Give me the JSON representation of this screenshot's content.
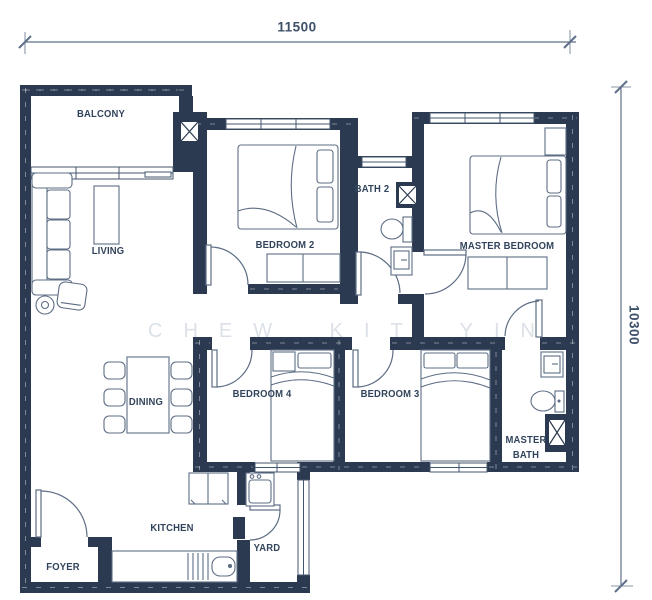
{
  "plan": {
    "type": "apartment-floor-plan",
    "watermark": "CHEW KIT YIN",
    "dimensions": {
      "width_label": "11500",
      "height_label": "10300"
    },
    "rooms": {
      "balcony": {
        "label": "BALCONY"
      },
      "living": {
        "label": "LIVING"
      },
      "dining": {
        "label": "DINING"
      },
      "bedroom2": {
        "label": "BEDROOM 2"
      },
      "bath2": {
        "label": "BATH 2"
      },
      "master_bedroom": {
        "label": "MASTER BEDROOM"
      },
      "bedroom4": {
        "label": "BEDROOM 4"
      },
      "bedroom3": {
        "label": "BEDROOM 3"
      },
      "master_bath": {
        "line1": "MASTER",
        "line2": "BATH"
      },
      "kitchen": {
        "label": "KITCHEN"
      },
      "yard": {
        "label": "YARD"
      },
      "foyer": {
        "label": "FOYER"
      }
    },
    "colors": {
      "wall": "#2b3a50",
      "furniture_line": "#5d6d84",
      "label_text": "#32445c",
      "dimension_text": "#3d5068",
      "watermark_text": "#dce1e8",
      "background": "#ffffff"
    }
  }
}
